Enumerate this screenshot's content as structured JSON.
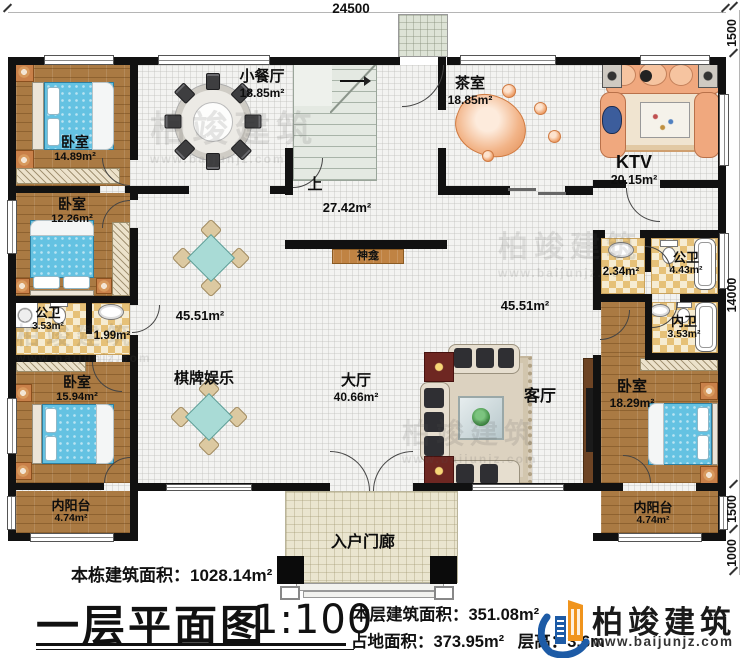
{
  "dimensions": {
    "top": "24500",
    "right": [
      "1500",
      "14000",
      "1500",
      "1000"
    ]
  },
  "rooms": {
    "bedroom_tl": {
      "name": "卧室",
      "area": "14.89m²"
    },
    "bedroom_ml": {
      "name": "卧室",
      "area": "12.26m²"
    },
    "bathroom_left": {
      "name": "公卫",
      "area": "3.53m²"
    },
    "vanity_left": {
      "area": "1.99m²"
    },
    "bedroom_bl": {
      "name": "卧室",
      "area": "15.94m²"
    },
    "balcony_left": {
      "name": "内阳台",
      "area": "4.74m²"
    },
    "dining": {
      "name": "小餐厅",
      "area": "18.85m²"
    },
    "stairs": {
      "label": "上"
    },
    "hall_center": {
      "area": "27.42m²"
    },
    "shrine": {
      "name": "神龛"
    },
    "open_left": {
      "area": "45.51m²"
    },
    "open_right": {
      "area": "45.51m²"
    },
    "chess": {
      "name": "棋牌娱乐"
    },
    "hall": {
      "name": "大厅",
      "area": "40.66m²"
    },
    "living": {
      "name": "客厅"
    },
    "tea": {
      "name": "茶室",
      "area": "18.85m²"
    },
    "ktv": {
      "name": "KTV",
      "area": "20.15m²"
    },
    "vanity_right": {
      "area": "2.34m²"
    },
    "bathroom_right": {
      "name": "公卫",
      "area": "4.43m²"
    },
    "bathroom_inner": {
      "name": "内卫",
      "area": "3.53m²"
    },
    "bedroom_br": {
      "name": "卧室",
      "area": "18.29m²"
    },
    "balcony_right": {
      "name": "内阳台",
      "area": "4.74m²"
    },
    "porch": {
      "name": "入户门廊"
    }
  },
  "title_block": {
    "total_label": "本栋建筑面积：",
    "total_value": "1028.14m²",
    "title": "一层平面图",
    "scale": "1:100",
    "floor_label": "本层建筑面积：",
    "floor_value": "351.08m²",
    "land_label": "占地面积：",
    "land_value": "373.95m²",
    "height_label": "层高：",
    "height_value": "3.6m"
  },
  "logo": {
    "name": "柏竣建筑",
    "url": "www.baijunjz.com"
  },
  "watermark": {
    "text": "柏竣建筑",
    "url": "www.baijunjz.com"
  },
  "colors": {
    "wall": "#111111",
    "wood_floor": "#aa7a43",
    "bath_tile": "#e6c178",
    "bed": "#64c2e2",
    "shrine_wood": "#c08343",
    "logo_blue": "#1d5ba6",
    "logo_orange": "#f0941d"
  }
}
